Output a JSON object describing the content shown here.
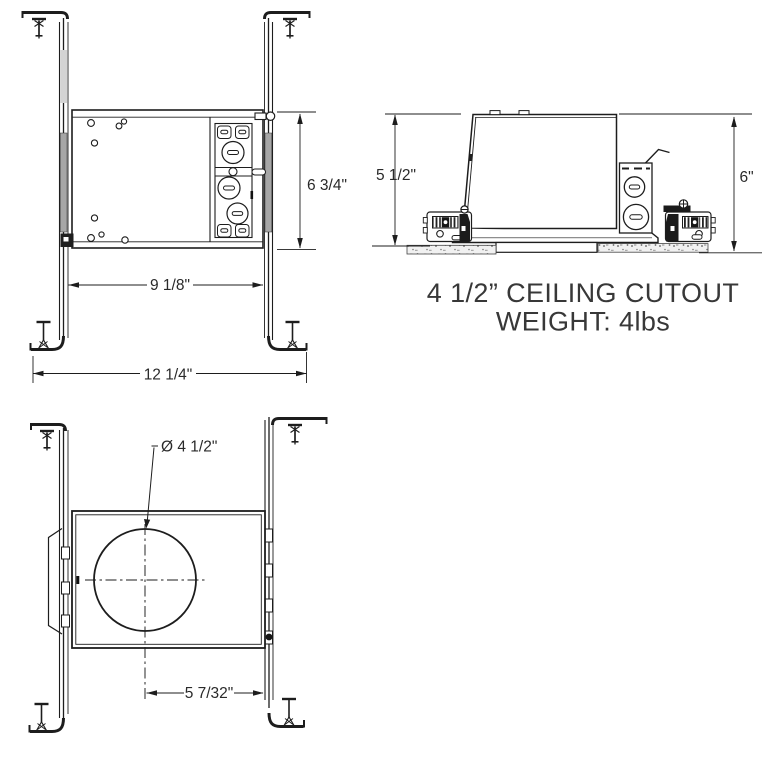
{
  "dimensions": {
    "front": {
      "height": "6 3/4\"",
      "housing_width": "9 1/8\"",
      "overall_width": "12 1/4\""
    },
    "side": {
      "housing_height": "5 1/2\"",
      "overall_height": "6\""
    },
    "bottom": {
      "cutout_diameter": "Ø 4 1/2\"",
      "center_offset": "5 7/32\""
    }
  },
  "notes": {
    "line1": "4 1/2” CEILING CUTOUT",
    "line2": "WEIGHT: 4lbs"
  },
  "colors": {
    "line": "#1d1d1d",
    "dim_text": "#2a2a2a",
    "note_text": "#383838",
    "bar_shade": "#a6a6a6",
    "ceiling_fill": "#f1f1f1"
  }
}
